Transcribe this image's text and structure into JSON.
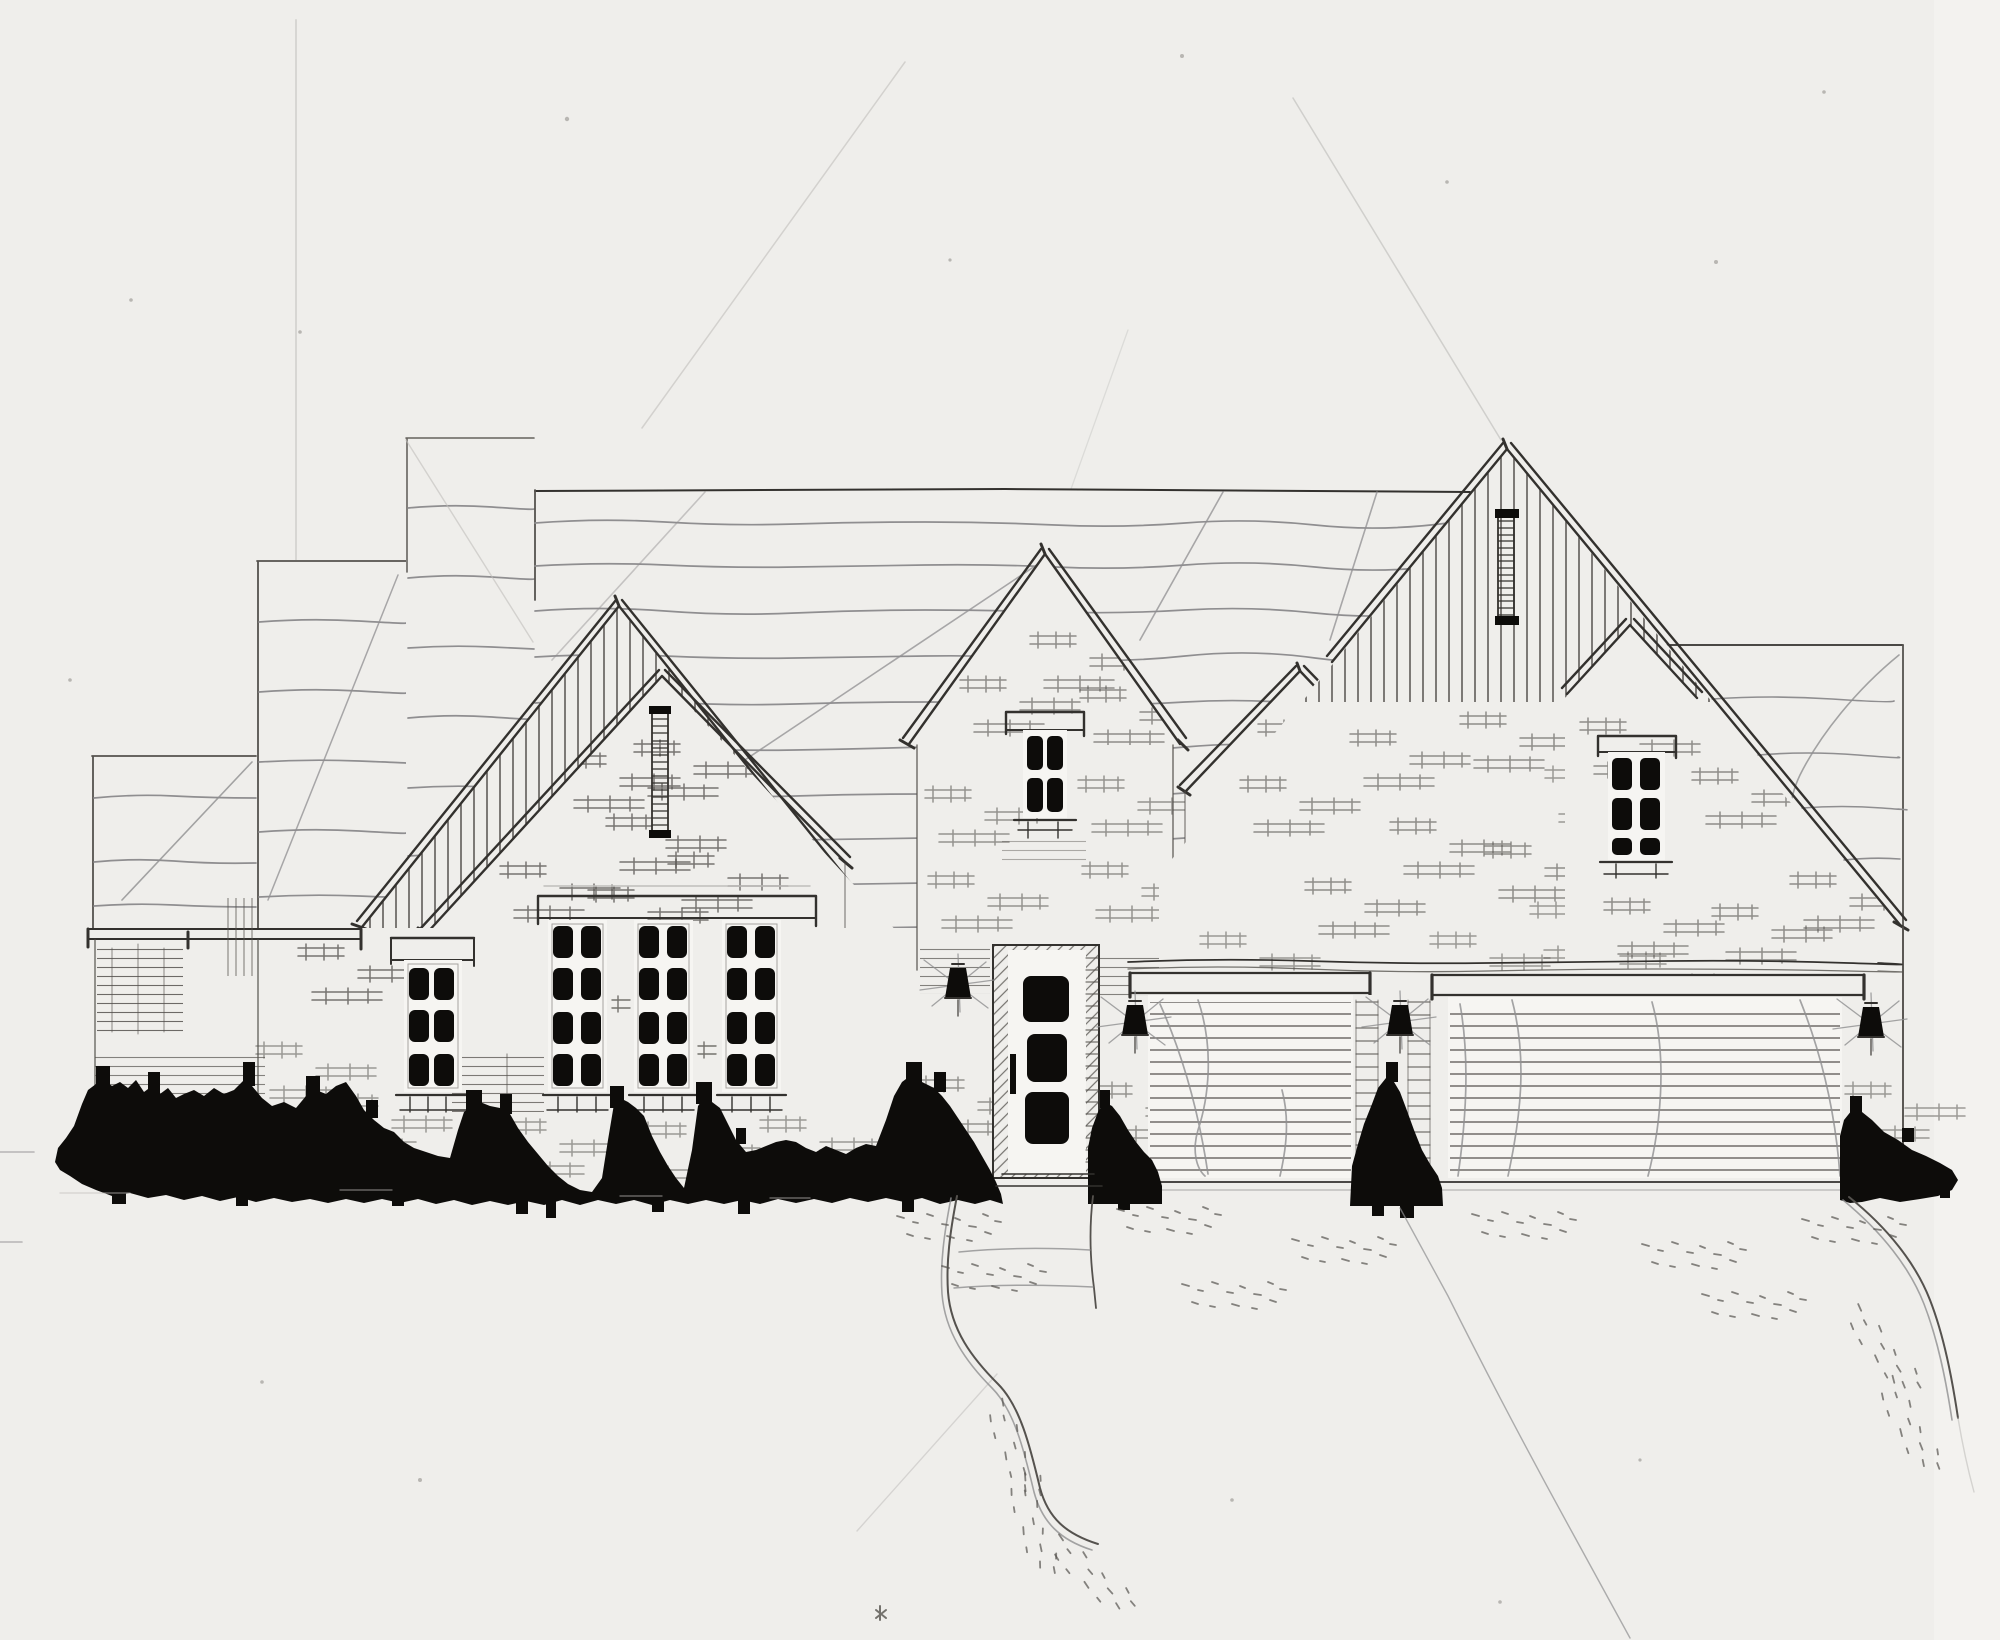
{
  "scene": {
    "title": "Hand-drawn ink and pencil front elevation sketch of a single-family house with steep gables, tall dark-paned windows, a front door, a single and a double garage door, black shrub silhouettes, a curved front walkway and a stippled driveway",
    "medium": "ink and pencil on paper",
    "elements": {
      "gables": 5,
      "vertical_siding_gables": 2,
      "gable_louvers": 2,
      "windows": {
        "tall_triple_unit": 3,
        "narrow_single": 1,
        "tower_window": 1,
        "small_gable_window": 1,
        "right_gable_window": 1
      },
      "front_door_panels": 3,
      "wall_sconces": 4,
      "garage_doors": {
        "single": 1,
        "double": 1
      },
      "shrub_clusters": 4,
      "walkways": 1,
      "driveways": 1
    }
  },
  "colors": {
    "paper": "#efeeeb",
    "paper-bright": "#f6f5f2",
    "paper-edge": "#f3f2ef",
    "ink": "#33312e",
    "ink-soft": "#55524e",
    "pencil": "#8f8e90",
    "pencil-light": "#bfbebb",
    "black": "#0d0c0a",
    "speck": "#b8b6b2"
  }
}
